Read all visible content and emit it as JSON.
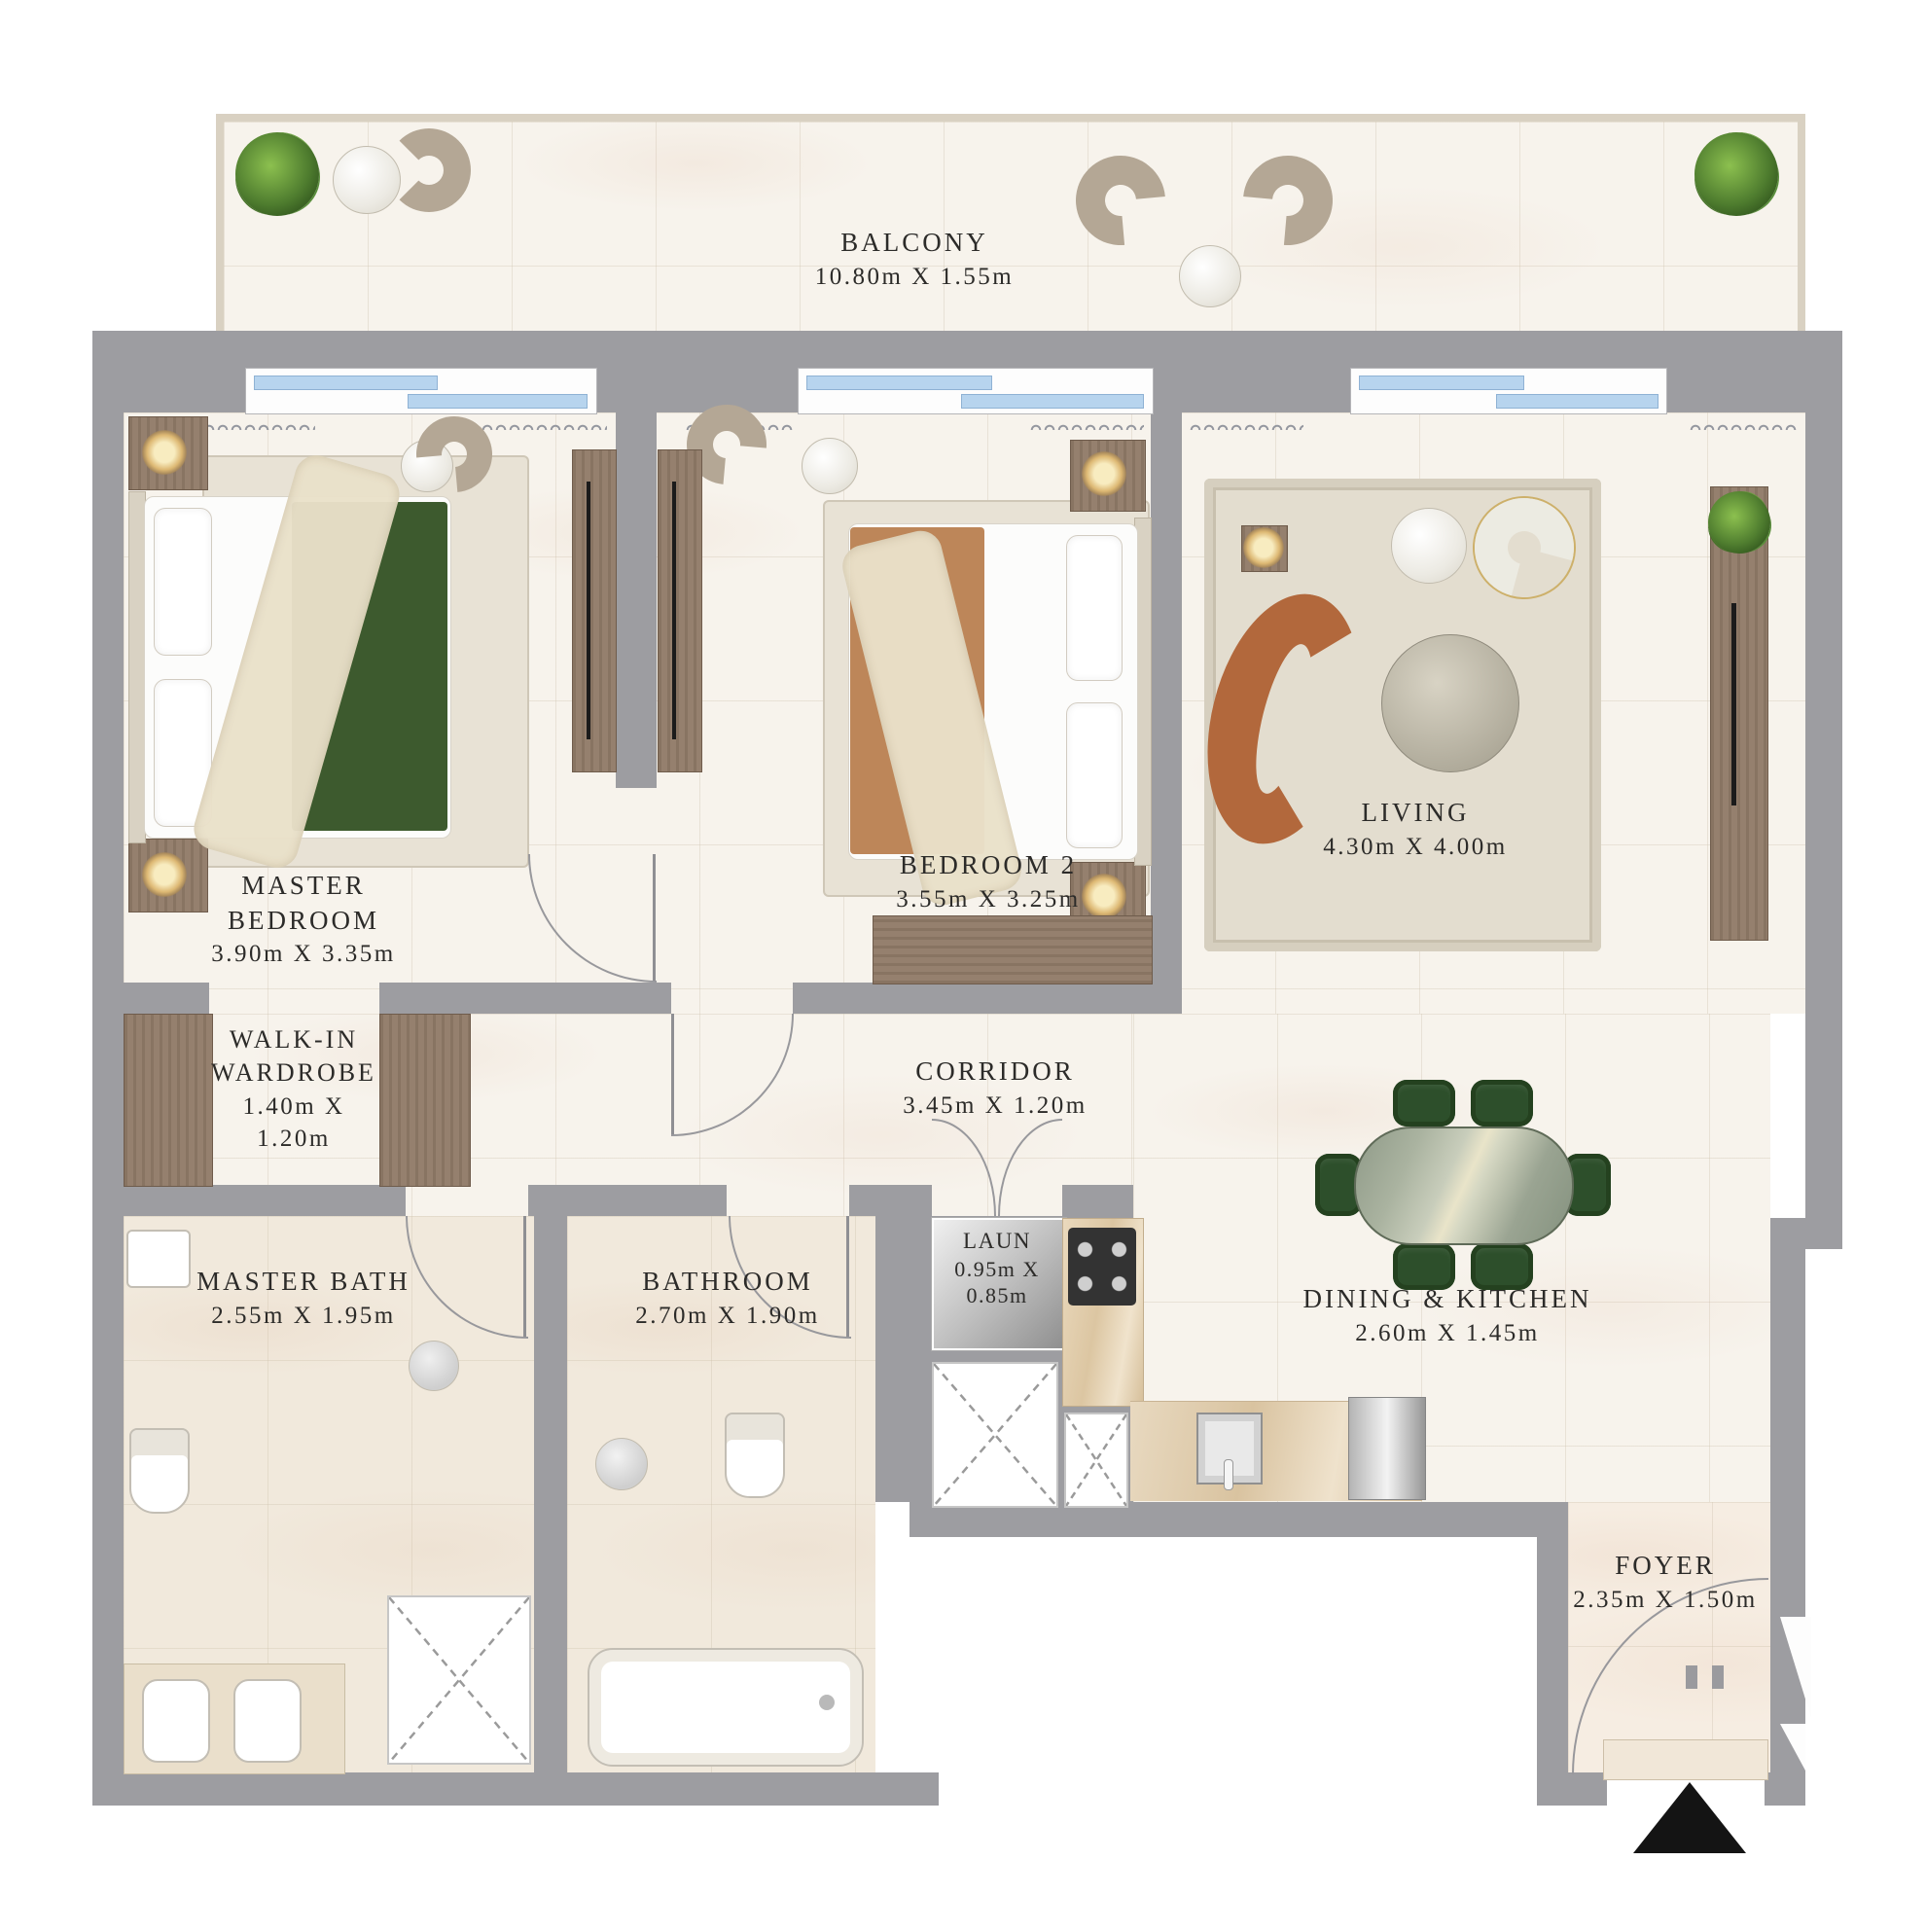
{
  "plan": {
    "title": "apartment-floor-plan",
    "rooms": {
      "balcony": {
        "label": "BALCONY",
        "dims": "10.80m X 1.55m"
      },
      "master_bedroom": {
        "label_line1": "MASTER",
        "label_line2": "BEDROOM",
        "dims": "3.90m X 3.35m"
      },
      "bedroom_2": {
        "label": "BEDROOM 2",
        "dims": "3.55m X 3.25m"
      },
      "living": {
        "label": "LIVING",
        "dims": "4.30m X 4.00m"
      },
      "walk_in_wardrobe": {
        "label_line1": "WALK-IN",
        "label_line2": "WARDROBE",
        "dims_line1": "1.40m X",
        "dims_line2": "1.20m"
      },
      "corridor": {
        "label": "CORRIDOR",
        "dims": "3.45m X 1.20m"
      },
      "master_bath": {
        "label": "MASTER BATH",
        "dims": "2.55m X 1.95m"
      },
      "bathroom": {
        "label": "BATHROOM",
        "dims": "2.70m X 1.90m"
      },
      "laundry": {
        "label": "LAUN",
        "dims_line1": "0.95m X",
        "dims_line2": "0.85m"
      },
      "dining_kitchen": {
        "label": "DINING & KITCHEN",
        "dims": "2.60m X 1.45m"
      },
      "foyer": {
        "label": "FOYER",
        "dims": "2.35m X 1.50m"
      }
    },
    "colors": {
      "wall_gray": "#9d9da1",
      "floor_cream": "#f7f3ec",
      "bath_floor": "#f1e9dc",
      "balcony_rail": "#d9d1c2",
      "window_glass": "#b7d4ee",
      "wood": "#95806e",
      "sofa_brown": "#b2683c",
      "dining_green": "#2d4f2b",
      "bed_blanket_green": "#3d5a2e",
      "bed_blanket_terracotta": "#bd8659",
      "plant_green": "#4f7d2f",
      "label_text": "#2c2b29",
      "entry_marker": "#141414"
    }
  }
}
